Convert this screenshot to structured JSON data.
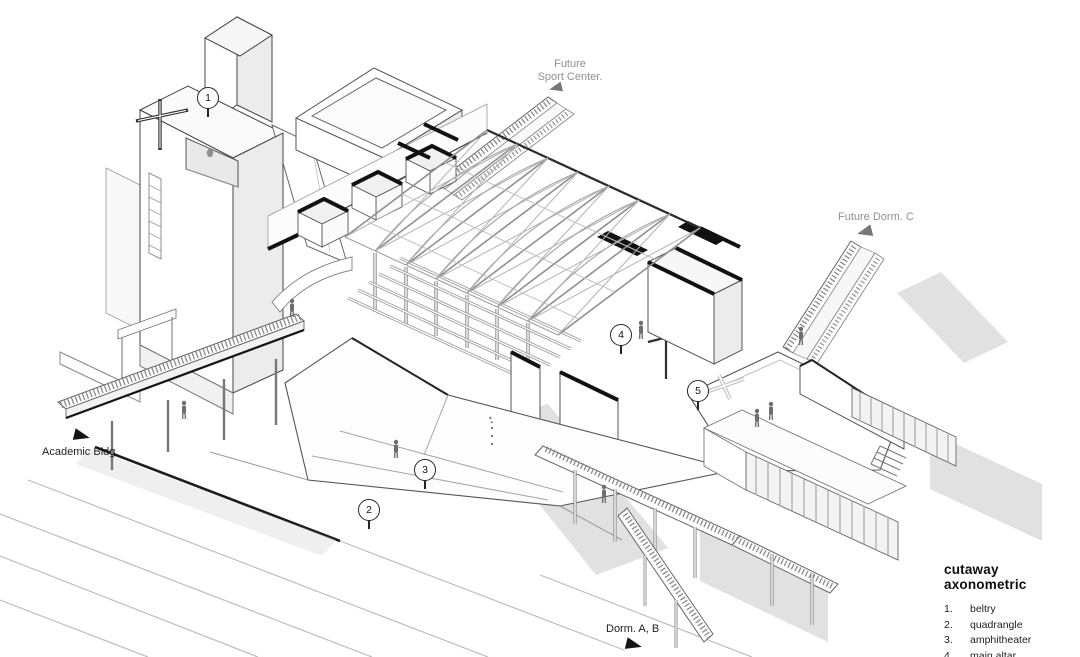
{
  "drawing": {
    "type": "cutaway axonometric",
    "line_color": "#3c3c3c",
    "poche_color": "#141414",
    "shadow_color": "#dcdcdc",
    "muted_label_color": "#8f8f8f"
  },
  "context_labels": {
    "sport_center_line1": "Future",
    "sport_center_line2": "Sport Center.",
    "dorm_c": "Future Dorm. C",
    "academic": "Academic Bldg.",
    "dorm_ab": "Dorm. A, B"
  },
  "markers": [
    {
      "number": "1"
    },
    {
      "number": "2"
    },
    {
      "number": "3"
    },
    {
      "number": "4"
    },
    {
      "number": "5"
    }
  ],
  "legend": {
    "title": "cutaway axonometric",
    "items": [
      {
        "num": "1.",
        "label": "beltry"
      },
      {
        "num": "2.",
        "label": "quadrangle"
      },
      {
        "num": "3.",
        "label": "amphitheater"
      },
      {
        "num": "4.",
        "label": "main altar"
      },
      {
        "num": "5.",
        "label": "outdoor altar"
      }
    ]
  }
}
